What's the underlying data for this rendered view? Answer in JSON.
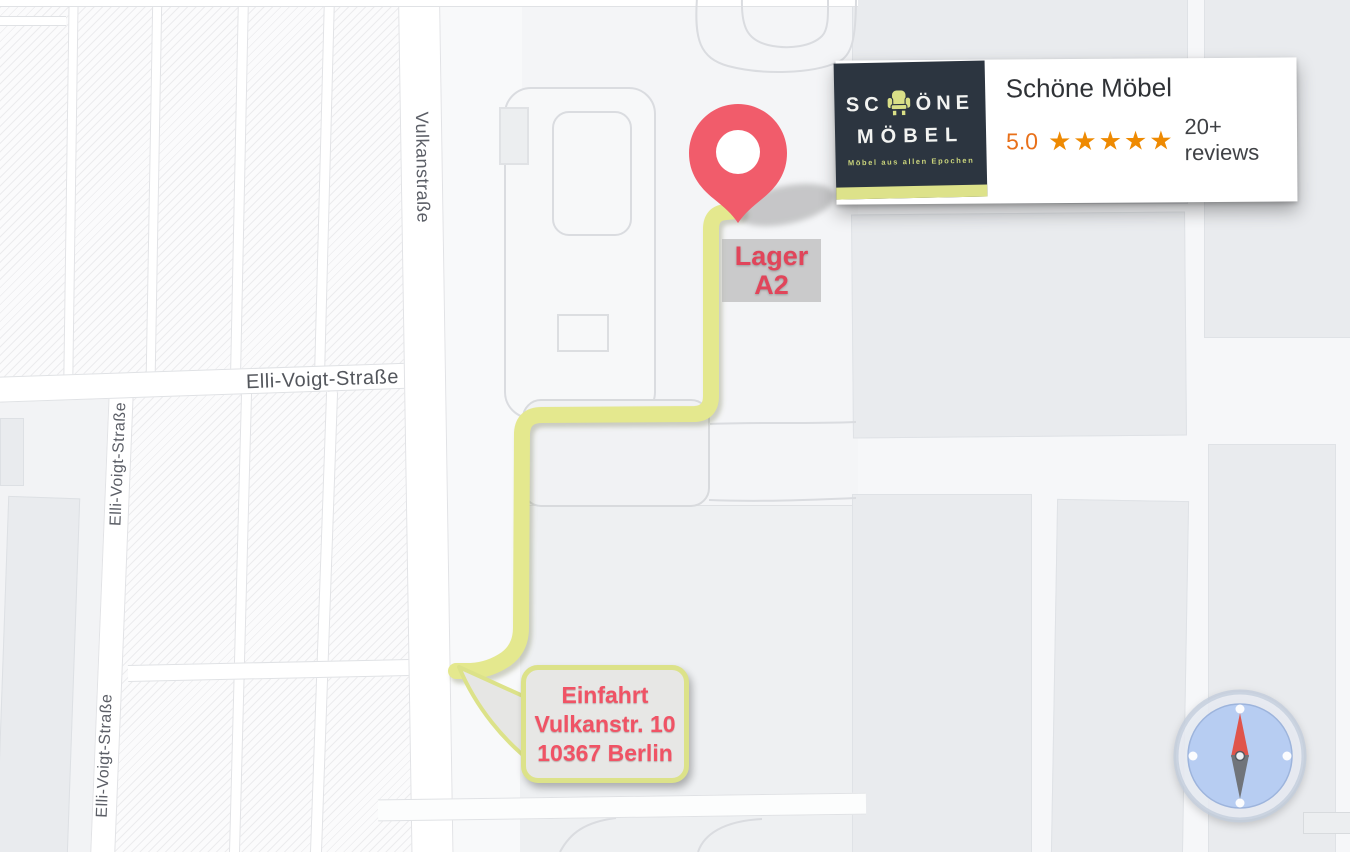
{
  "map": {
    "street_labels": {
      "vulkanstrasse": "Vulkanstraße",
      "elli_voigt_strasse": "Elli-Voigt-Straße"
    },
    "marker_label": {
      "line1": "Lager",
      "line2": "A2"
    },
    "entrance_callout": {
      "line1": "Einfahrt",
      "line2": "Vulkanstr. 10",
      "line3": "10367 Berlin"
    }
  },
  "business_card": {
    "name": "Schöne Möbel",
    "rating": "5.0",
    "stars": "★★★★★",
    "reviews": "20+ reviews",
    "logo": {
      "word1_pre": "SC",
      "word1_post": "ÖNE",
      "word2": "MÖBEL",
      "tagline": "Möbel aus allen Epochen"
    }
  },
  "colors": {
    "route": "#e4e88e",
    "pin": "#f15c6b",
    "marker_text": "#e1455a",
    "callout_text": "#f05365",
    "logo_bg": "#2c3540",
    "logo_accent": "#dde28a",
    "rating_orange": "#e8701a",
    "star_orange": "#ee8a02",
    "compass_blue": "#b7cdf2"
  }
}
